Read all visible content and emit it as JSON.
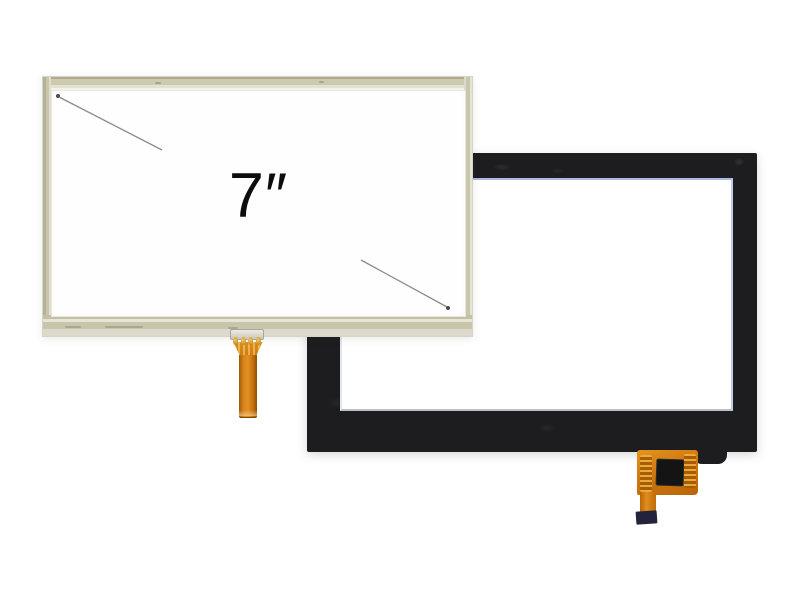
{
  "image": {
    "type": "product photo",
    "subject": "7-inch touch screen panels: resistive touch screen (front) and capacitive touch panel (back)"
  },
  "background_color": "#ffffff",
  "front_panel": {
    "name": "7-inch resistive touch screen",
    "size_label": "7″",
    "frame_color": "#c9c6ab",
    "glass_color": "#fefefe",
    "bottom_edge_color": "#dcdacd",
    "dimension_line_color": "#8c8c85",
    "dimension_line_dot_color": "#4a4a45",
    "connector_body_color": "#d9d6cc",
    "connector_pin_color": "#d9a33b",
    "flex_cable_color": "#d4790f"
  },
  "back_panel": {
    "name": "capacitive touch panel",
    "bezel_color": "#1d1d20",
    "window_color": "#ffffff",
    "window_edge_tint": "#5a73c8",
    "flex_cable_color": "#cf7710",
    "flex_contact_color": "#eaaf3a",
    "controller_ic_color": "#141414",
    "tail_stiffener_color": "#23233b"
  }
}
